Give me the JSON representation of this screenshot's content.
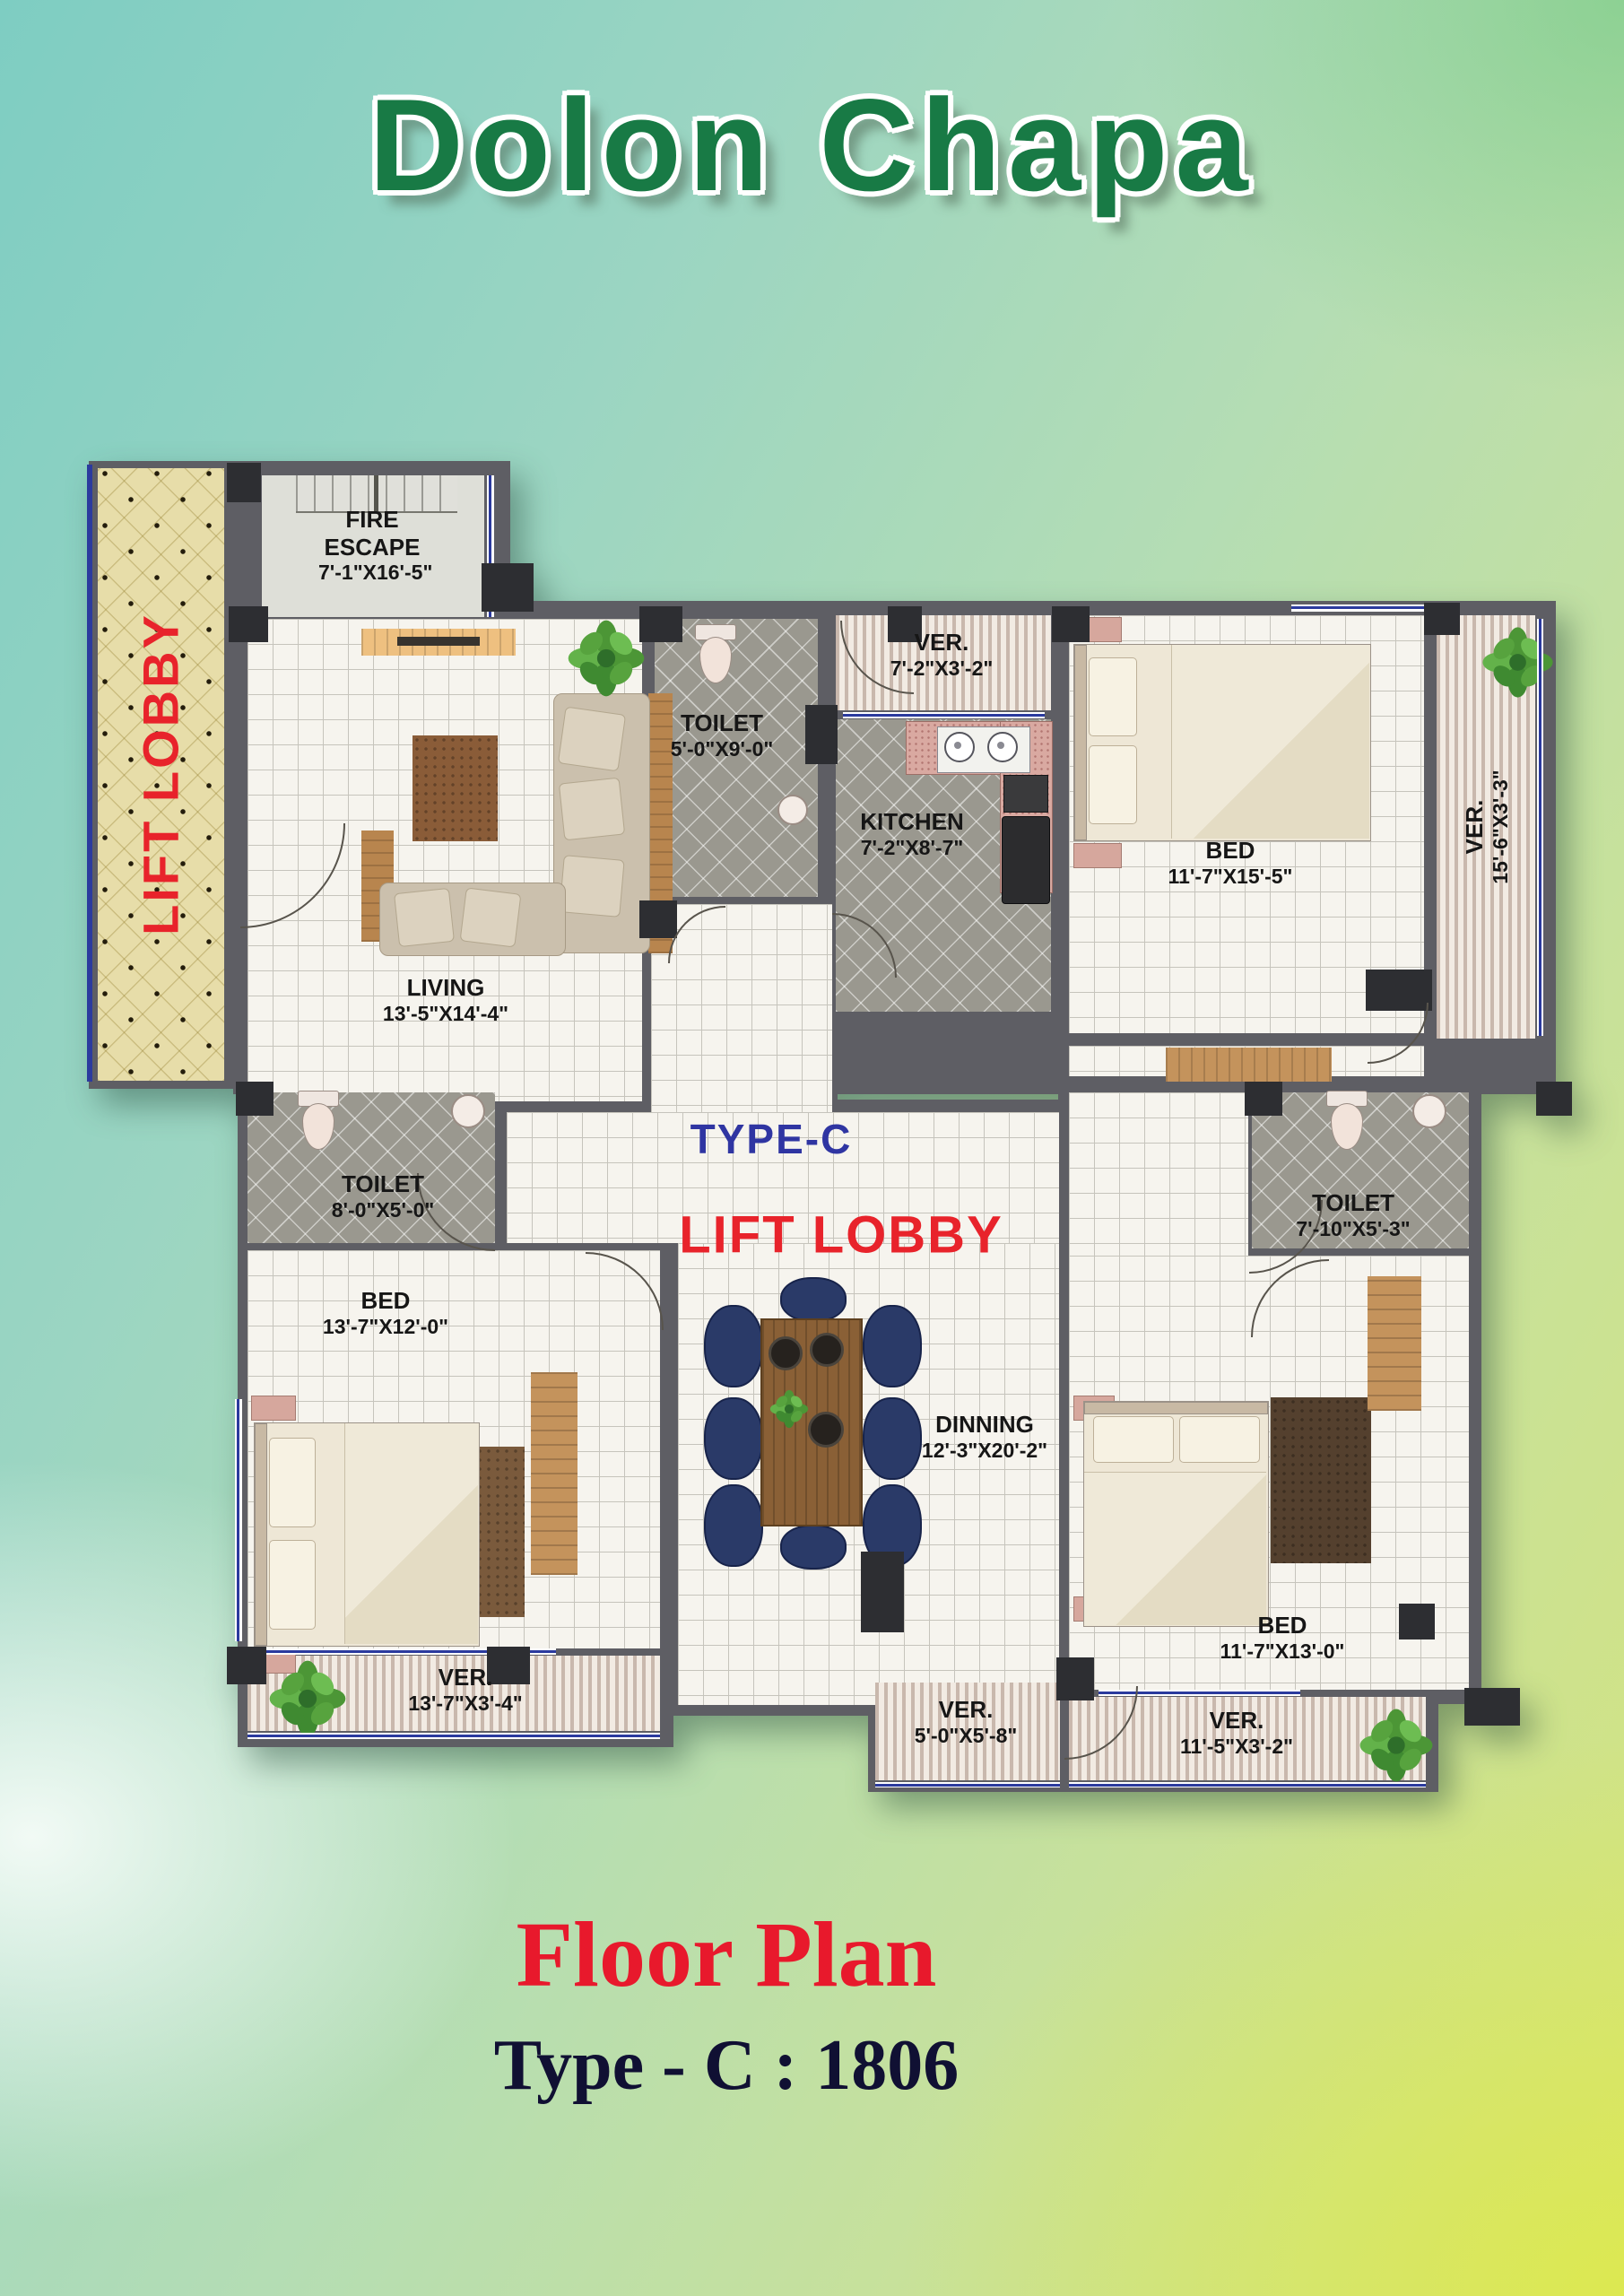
{
  "title": "Dolon Chapa",
  "footer": {
    "title": "Floor Plan",
    "subtitle": "Type - C : 1806"
  },
  "plan": {
    "type_label": "TYPE-C",
    "center_lobby_label": "LIFT LOBBY",
    "side_lobby_label": "LIFT LOBBY",
    "rooms": {
      "fire_escape": {
        "name": "FIRE ESCAPE",
        "dim": "7'-1\"X16'-5\""
      },
      "living": {
        "name": "LIVING",
        "dim": "13'-5\"X14'-4\""
      },
      "toilet_top": {
        "name": "TOILET",
        "dim": "5'-0\"X9'-0\""
      },
      "ver_top": {
        "name": "VER.",
        "dim": "7'-2\"X3'-2\""
      },
      "kitchen": {
        "name": "KITCHEN",
        "dim": "7'-2\"X8'-7\""
      },
      "bed_top_right": {
        "name": "BED",
        "dim": "11'-7\"X15'-5\""
      },
      "ver_right": {
        "name": "VER.",
        "dim": "15'-6\"X3'-3\""
      },
      "toilet_left": {
        "name": "TOILET",
        "dim": "8'-0\"X5'-0\""
      },
      "toilet_right": {
        "name": "TOILET",
        "dim": "7'-10\"X5'-3\""
      },
      "bed_left": {
        "name": "BED",
        "dim": "13'-7\"X12'-0\""
      },
      "dining": {
        "name": "DINNING",
        "dim": "12'-3\"X20'-2\""
      },
      "bed_bottom_right": {
        "name": "BED",
        "dim": "11'-7\"X13'-0\""
      },
      "ver_bottom_left": {
        "name": "VER.",
        "dim": "13'-7\"X3'-4\""
      },
      "ver_bottom_center": {
        "name": "VER.",
        "dim": "5'-0\"X5'-8\""
      },
      "ver_bottom_right": {
        "name": "VER.",
        "dim": "11'-5\"X3'-2\""
      }
    },
    "colors": {
      "title_green": "#187a45",
      "label_red": "#e8232b",
      "type_blue": "#2f35a2",
      "footer_red": "#e8192c",
      "footer_dark": "#101033"
    }
  }
}
